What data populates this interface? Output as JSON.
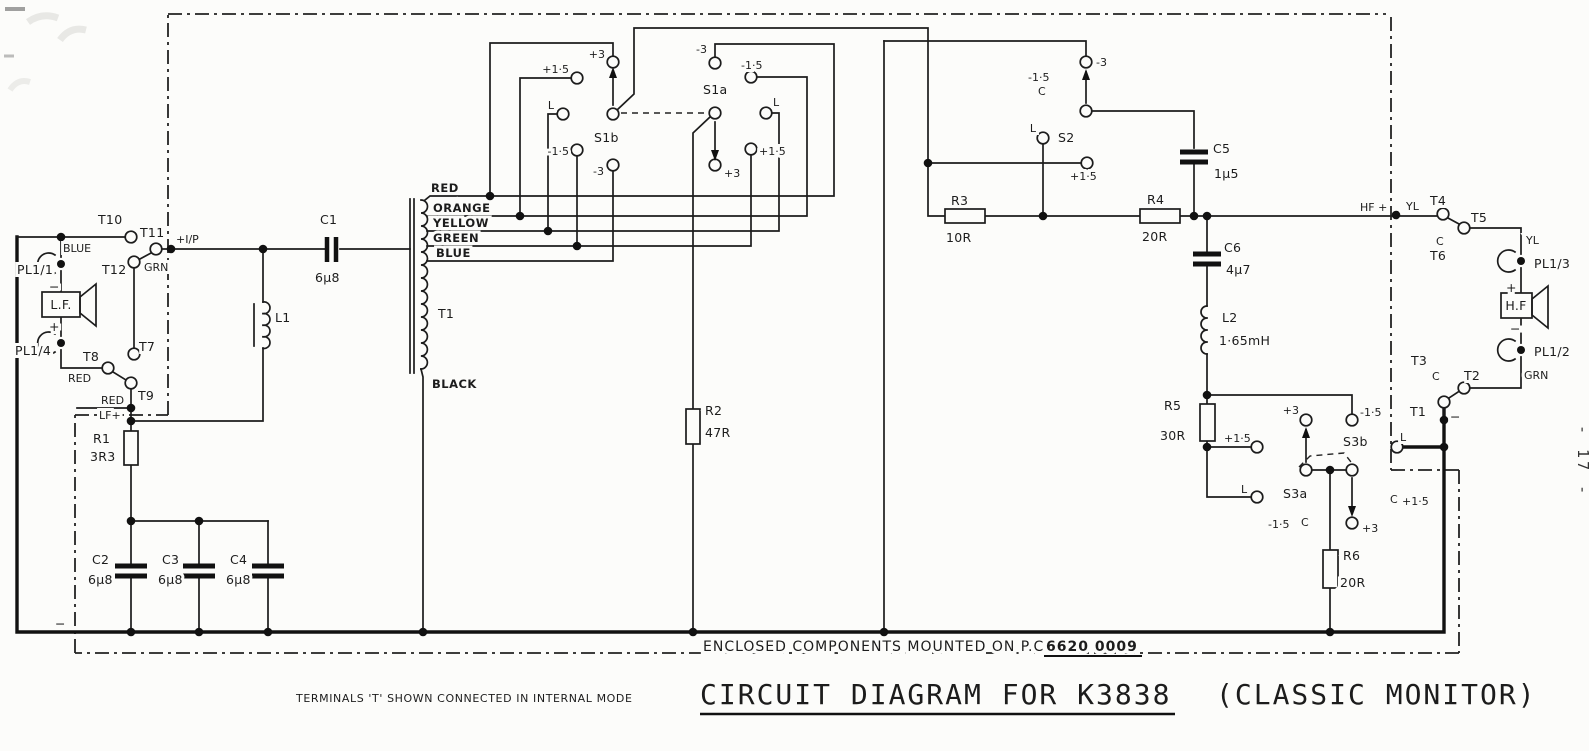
{
  "document": {
    "title": "CIRCUIT DIAGRAM FOR K3838",
    "subtitle": "(CLASSIC MONITOR)",
    "note_terminals": "TERMINALS 'T' SHOWN CONNECTED IN INTERNAL MODE",
    "note_enclosed": "ENCLOSED COMPONENTS MOUNTED ON P.C.B",
    "pcb_number": "6620 0009",
    "page_number": "- 17 -"
  },
  "colors": {
    "ink": "#1c1c1c",
    "paper": "#fcfcfa"
  },
  "components": {
    "r1": {
      "ref": "R1",
      "value": "3R3"
    },
    "r2": {
      "ref": "R2",
      "value": "47R"
    },
    "r3": {
      "ref": "R3",
      "value": "10R"
    },
    "r4": {
      "ref": "R4",
      "value": "20R"
    },
    "r5": {
      "ref": "R5",
      "value": "30R"
    },
    "r6": {
      "ref": "R6",
      "value": "20R"
    },
    "c1": {
      "ref": "C1",
      "value": "6µ8"
    },
    "c2": {
      "ref": "C2",
      "value": "6µ8"
    },
    "c3": {
      "ref": "C3",
      "value": "6µ8"
    },
    "c4": {
      "ref": "C4",
      "value": "6µ8"
    },
    "c5": {
      "ref": "C5",
      "value": "1µ5"
    },
    "c6": {
      "ref": "C6",
      "value": "4µ7"
    },
    "l1": {
      "ref": "L1"
    },
    "l2": {
      "ref": "L2",
      "value": "1·65mH"
    },
    "transformer": {
      "ref": "T1",
      "taps": [
        "RED",
        "ORANGE",
        "YELLOW",
        "GREEN",
        "BLUE"
      ],
      "bottom_lead": "BLACK"
    },
    "lf_speaker": {
      "label": "L.F."
    },
    "hf_speaker": {
      "label": "H.F"
    }
  },
  "switches": {
    "s1a": "S1a",
    "s1b": "S1b",
    "s2": "S2",
    "s3a": "S3a",
    "s3b": "S3b",
    "positions": {
      "plus3": "+3",
      "plus15": "+1·5",
      "link": "L",
      "minus15": "-1·5",
      "minus3": "-3",
      "common": "C"
    }
  },
  "terminals": {
    "t1": "T1",
    "t2": "T2",
    "t3": "T3",
    "t4": "T4",
    "t5": "T5",
    "t6": "T6",
    "t7": "T7",
    "t8": "T8",
    "t9": "T9",
    "t10": "T10",
    "t11": "T11",
    "t12": "T12"
  },
  "connectors": {
    "pl1_1": "PL1/1",
    "pl1_2": "PL1/2",
    "pl1_3": "PL1/3",
    "pl1_4": "PL1/4"
  },
  "wire_labels": {
    "input": "+I/P",
    "blue": "BLUE",
    "grn": "GRN",
    "red": "RED",
    "lf_plus": "LF+",
    "hf_plus": "HF +",
    "yl": "YL",
    "minus": "−",
    "plus": "+"
  }
}
